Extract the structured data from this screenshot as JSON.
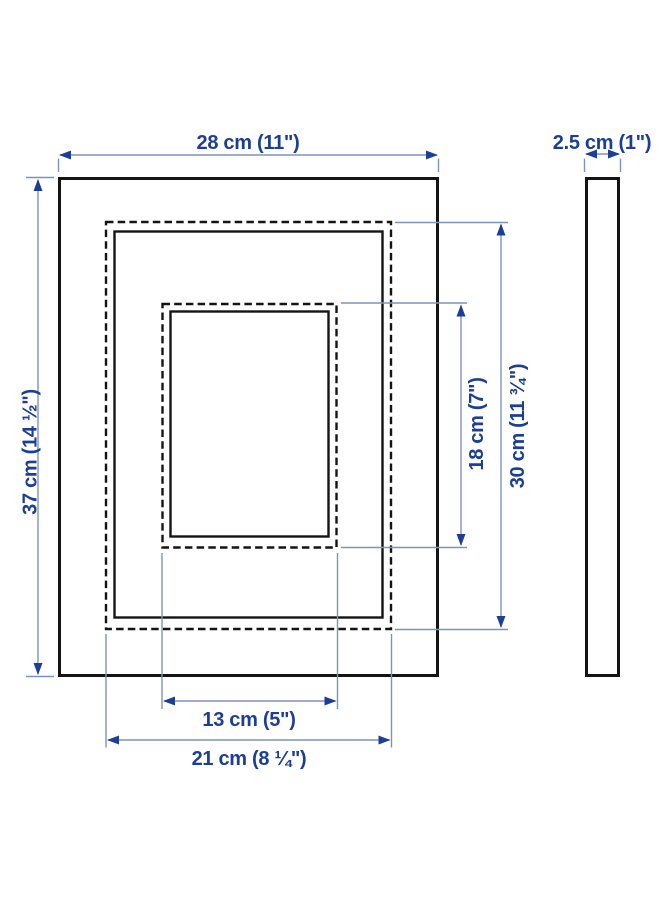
{
  "diagram": {
    "type": "product-dimension-diagram",
    "views": {
      "front": "frame front view with mat and photo opening",
      "side": "frame side profile view"
    },
    "labels": {
      "outer_width": "28 cm (11\")",
      "outer_height": "37 cm (14 ½\")",
      "depth": "2.5 cm (1\")",
      "mat_height": "30 cm (11 ¾\")",
      "opening_height": "18 cm (7\")",
      "opening_width": "13 cm (5\")",
      "mat_width": "21 cm (8 ¼\")"
    },
    "measurements": {
      "outer_width": {
        "cm": "28",
        "inches": "11"
      },
      "outer_height": {
        "cm": "37",
        "inches": "14 ½"
      },
      "depth": {
        "cm": "2.5",
        "inches": "1"
      },
      "mat_height": {
        "cm": "30",
        "inches": "11 ¾"
      },
      "opening_height": {
        "cm": "18",
        "inches": "7"
      },
      "opening_width": {
        "cm": "13",
        "inches": "5"
      },
      "mat_width": {
        "cm": "21",
        "inches": "8 ¼"
      }
    },
    "colors": {
      "background": "#ffffff",
      "artwork_line": "#141414",
      "dimension_line": "#7e93bc",
      "dimension_text": "#1d3e95",
      "arrowhead": "#1d3e95"
    }
  }
}
